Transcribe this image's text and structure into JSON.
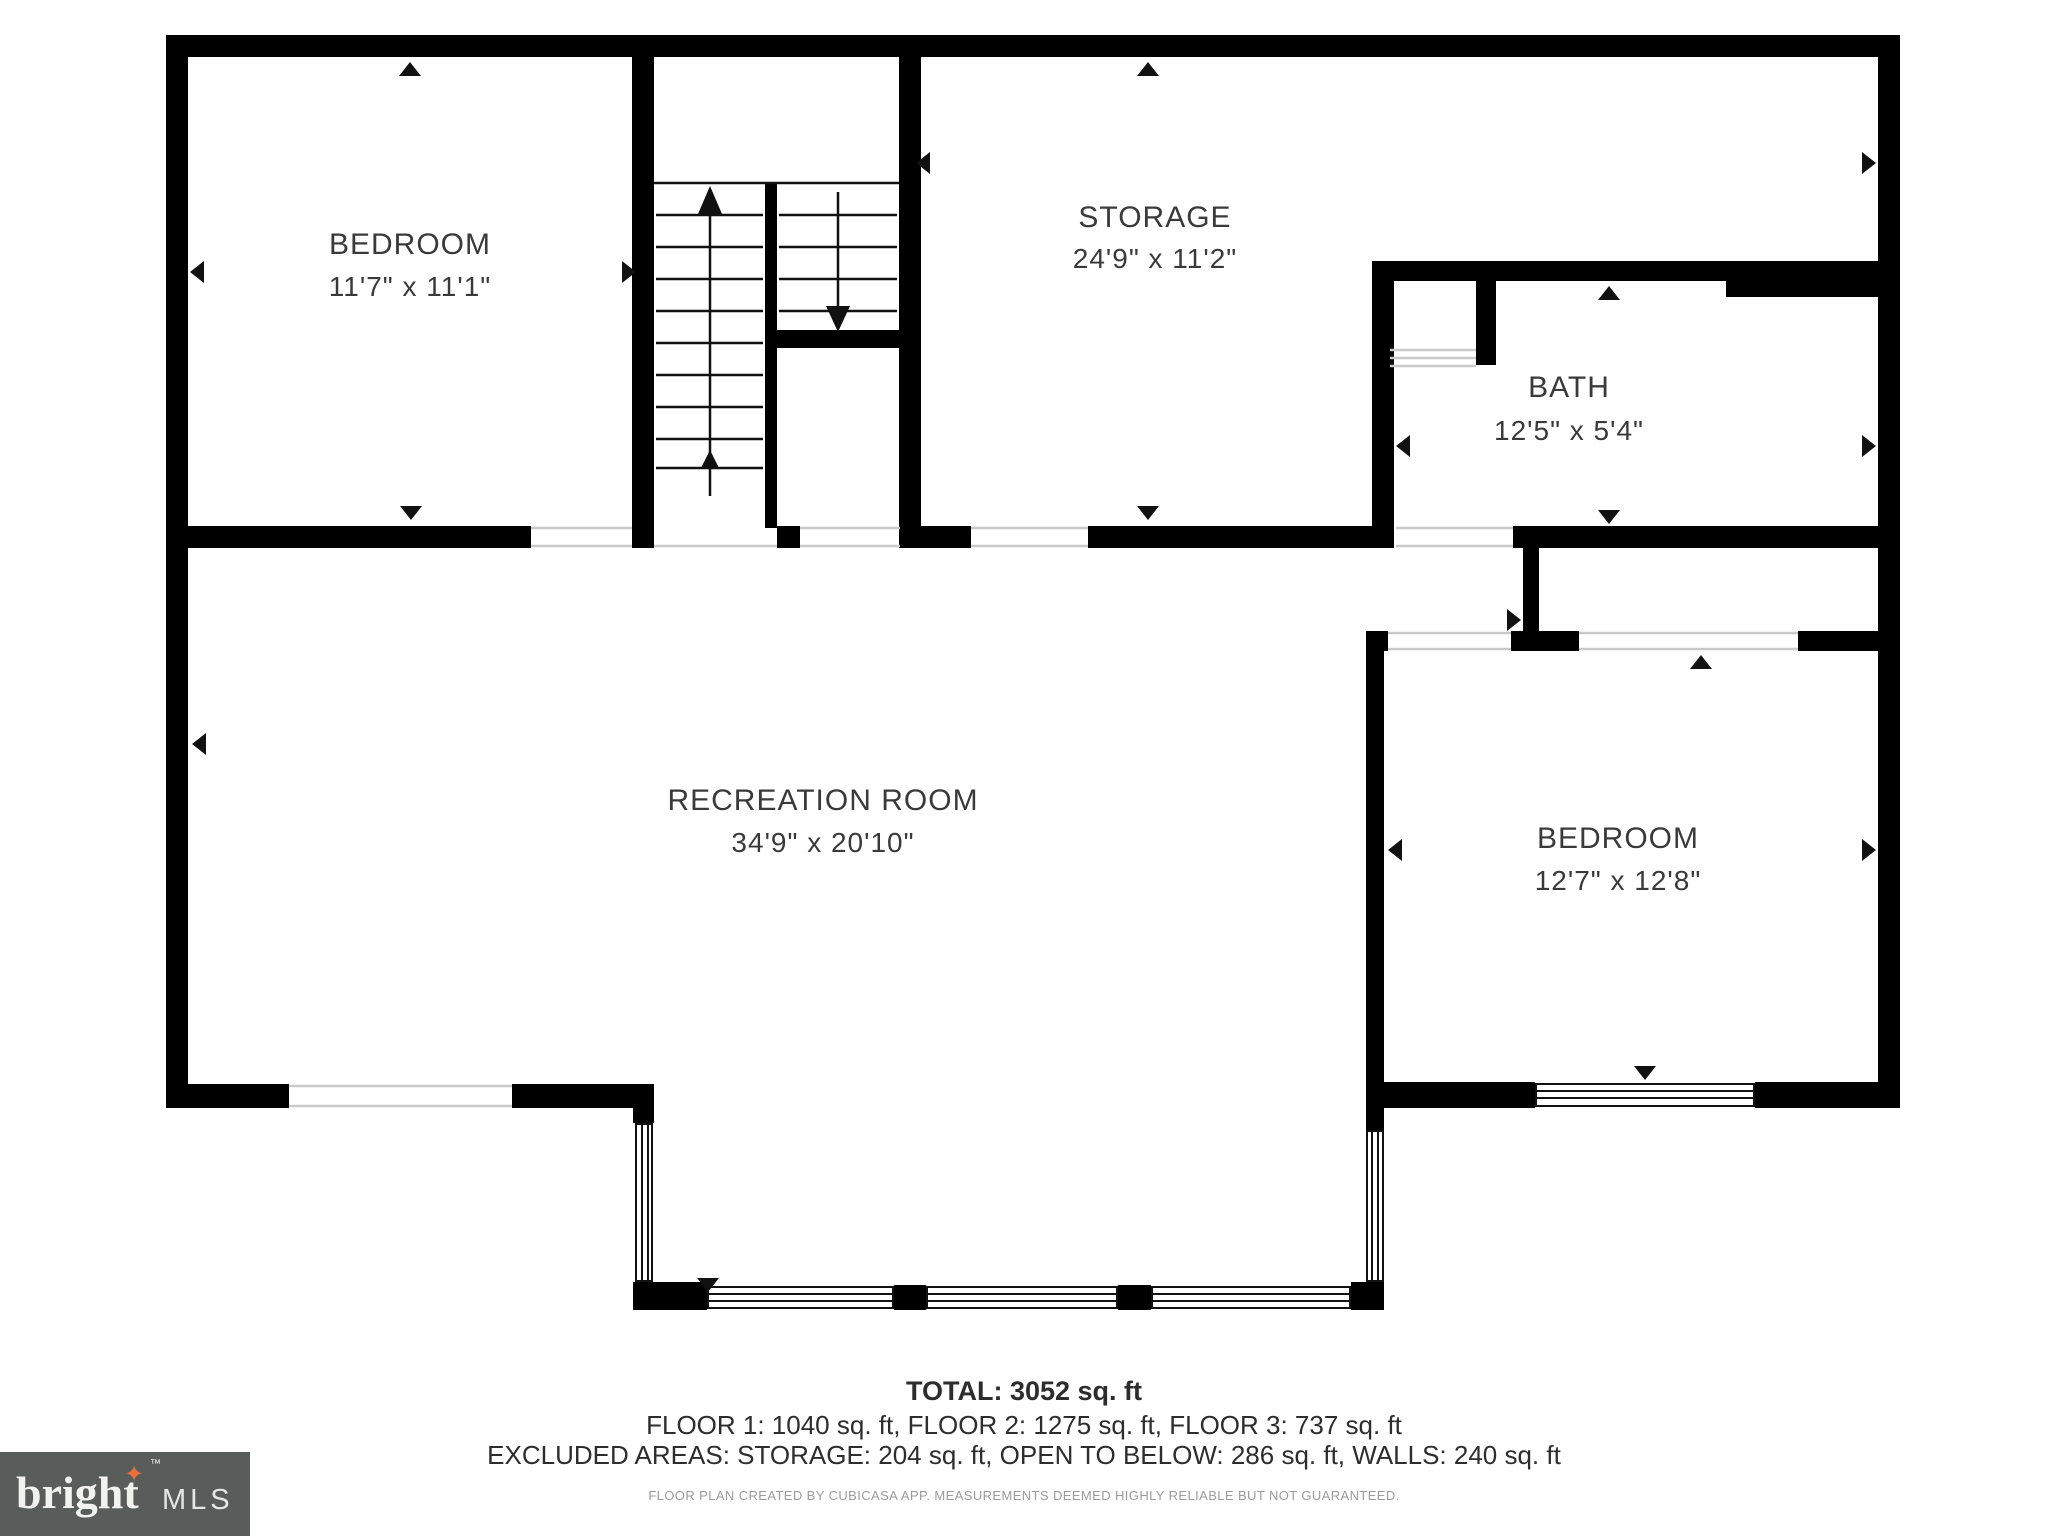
{
  "plan": {
    "rooms": [
      {
        "name": "BEDROOM",
        "dims": "11'7\" x 11'1\""
      },
      {
        "name": "STORAGE",
        "dims": "24'9\" x 11'2\""
      },
      {
        "name": "BATH",
        "dims": "12'5\" x 5'4\""
      },
      {
        "name": "RECREATION ROOM",
        "dims": "34'9\" x 20'10\""
      },
      {
        "name": "BEDROOM",
        "dims": "12'7\" x 12'8\""
      }
    ]
  },
  "footer": {
    "total": "TOTAL: 3052 sq. ft",
    "floors": "FLOOR 1: 1040 sq. ft, FLOOR 2: 1275 sq. ft, FLOOR 3: 737 sq. ft",
    "excluded": "EXCLUDED AREAS: STORAGE: 204 sq. ft, OPEN TO BELOW: 286 sq. ft, WALLS: 240 sq. ft",
    "disclaimer": "FLOOR PLAN CREATED BY CUBICASA APP. MEASUREMENTS DEEMED HIGHLY RELIABLE BUT NOT GUARANTEED."
  },
  "logo": {
    "brand": "bright",
    "suffix": "MLS",
    "tm": "™",
    "star": "✦",
    "background": "#585d5c",
    "star_color": "#e76f3c"
  },
  "colors": {
    "wall": "#000000",
    "label_text": "#3a3a3a",
    "opening_line": "#c9c9c9",
    "disclaimer_text": "#9b9b9b"
  }
}
